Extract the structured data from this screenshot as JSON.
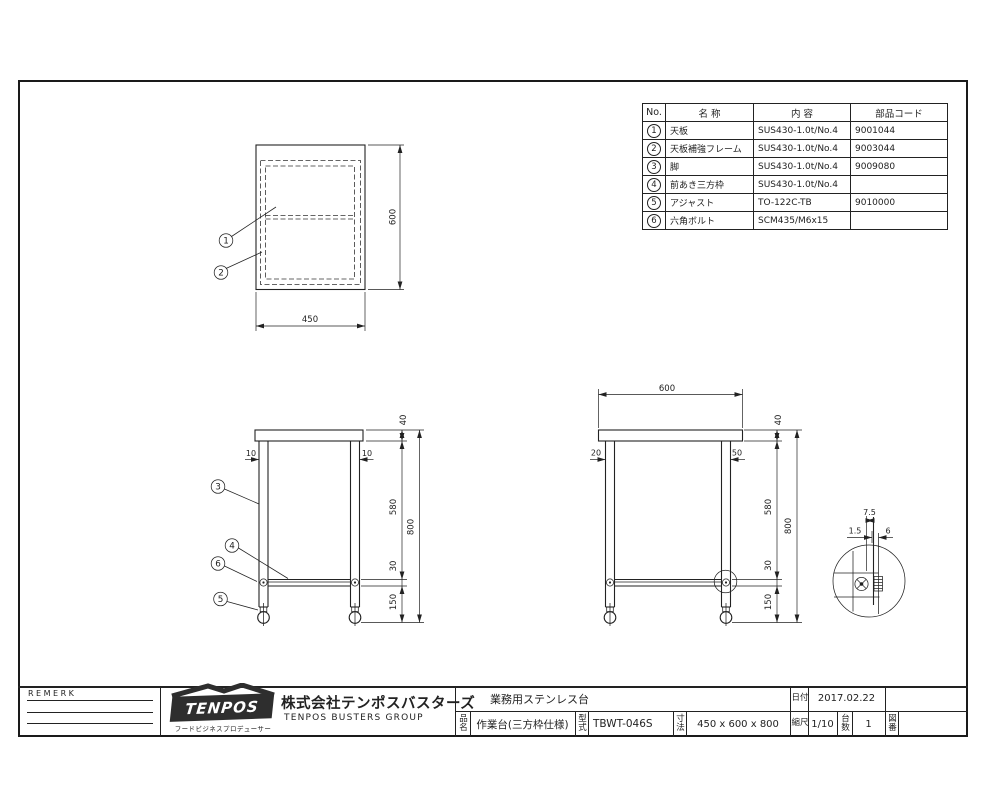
{
  "colors": {
    "line": "#222222",
    "background": "#ffffff",
    "logo_bg": "#2e2e2e"
  },
  "parts_table": {
    "headers": {
      "no": "No.",
      "name": "名 称",
      "spec": "内 容",
      "code": "部品コード"
    },
    "rows": [
      {
        "no": "1",
        "name": "天板",
        "spec": "SUS430-1.0t/No.4",
        "code": "9001044"
      },
      {
        "no": "2",
        "name": "天板補強フレーム",
        "spec": "SUS430-1.0t/No.4",
        "code": "9003044"
      },
      {
        "no": "3",
        "name": "脚",
        "spec": "SUS430-1.0t/No.4",
        "code": "9009080"
      },
      {
        "no": "4",
        "name": "前あき三方枠",
        "spec": "SUS430-1.0t/No.4",
        "code": ""
      },
      {
        "no": "5",
        "name": "アジャスト",
        "spec": "TO-122C-TB",
        "code": "9010000"
      },
      {
        "no": "6",
        "name": "六角ボルト",
        "spec": "SCM435/M6x15",
        "code": ""
      }
    ]
  },
  "plan_view": {
    "balloon_1": "1",
    "balloon_2": "2",
    "dim_width": "450",
    "dim_depth": "600"
  },
  "front_view": {
    "balloon_3": "3",
    "balloon_4": "4",
    "balloon_5": "5",
    "balloon_6": "6",
    "dim_inset_left": "10",
    "dim_inset_right": "10",
    "dim_top": "40",
    "dim_leg": "580",
    "dim_frame": "30",
    "dim_foot": "150",
    "dim_height": "800"
  },
  "side_view": {
    "dim_width": "600",
    "dim_inset_left": "20",
    "dim_inset_right": "50",
    "dim_top": "40",
    "dim_leg": "580",
    "dim_frame": "30",
    "dim_foot": "150",
    "dim_height": "800"
  },
  "detail_view": {
    "dim_a": "7.5",
    "dim_b": "1.5",
    "dim_c": "6"
  },
  "title_block": {
    "remark_label": "REMERK",
    "logo_text": "TENPOS",
    "logo_sub": "フードビジネスプロデューサー",
    "company_name": "株式会社テンポスバスターズ",
    "company_group": "TENPOS BUSTERS GROUP",
    "product_type": "業務用ステンレス台",
    "date_label": "日付",
    "date_value": "2017.02.22",
    "name_label": "品名",
    "name_value": "作業台(三方枠仕様)",
    "model_label": "型式",
    "model_value": "TBWT-046S",
    "size_label": "寸法",
    "size_value": "450 x 600 x 800",
    "scale_label": "縮尺",
    "scale_value": "1/10",
    "qty_label": "台数",
    "qty_value": "1",
    "dwg_no_label": "図番",
    "dwg_no_value": ""
  }
}
